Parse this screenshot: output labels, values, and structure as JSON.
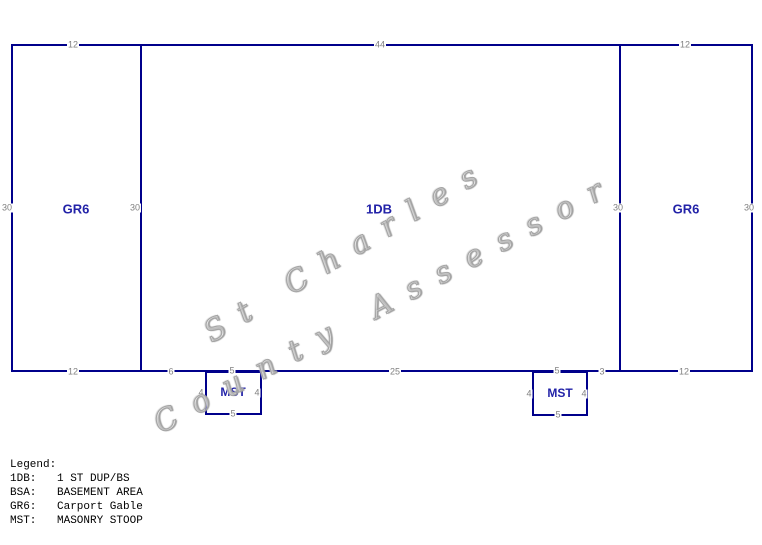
{
  "colors": {
    "line": "#00008b",
    "area_label": "#2222a8",
    "dimension_text": "#808080",
    "legend_text": "#000000",
    "watermark": "#a4a4a4"
  },
  "sections": {
    "left": {
      "label": "GR6"
    },
    "center": {
      "label": "1DB"
    },
    "right": {
      "label": "GR6"
    }
  },
  "dimensions": {
    "top_left": "12",
    "top_center": "44",
    "top_right": "12",
    "left_outer": "30",
    "left_inner": "30",
    "right_inner": "30",
    "right_outer": "30",
    "bottom_left": "12",
    "bottom_seg_left": "6",
    "bottom_seg_center": "25",
    "bottom_seg_right": "3",
    "bottom_right": "12"
  },
  "stoops": {
    "left": {
      "label": "MST",
      "top": "5",
      "side_left": "4",
      "side_right": "4",
      "bottom": "5"
    },
    "right": {
      "label": "MST",
      "top": "5",
      "side_left": "4",
      "side_right": "4",
      "bottom": "5"
    }
  },
  "watermark": {
    "line1": "St Charles",
    "line2": "County Assessor"
  },
  "legend": {
    "title": "Legend:",
    "items": [
      {
        "code": "1DB:",
        "desc": "1 ST DUP/BS"
      },
      {
        "code": "BSA:",
        "desc": "BASEMENT AREA"
      },
      {
        "code": "GR6:",
        "desc": "Carport Gable"
      },
      {
        "code": "MST:",
        "desc": "MASONRY STOOP"
      }
    ]
  }
}
